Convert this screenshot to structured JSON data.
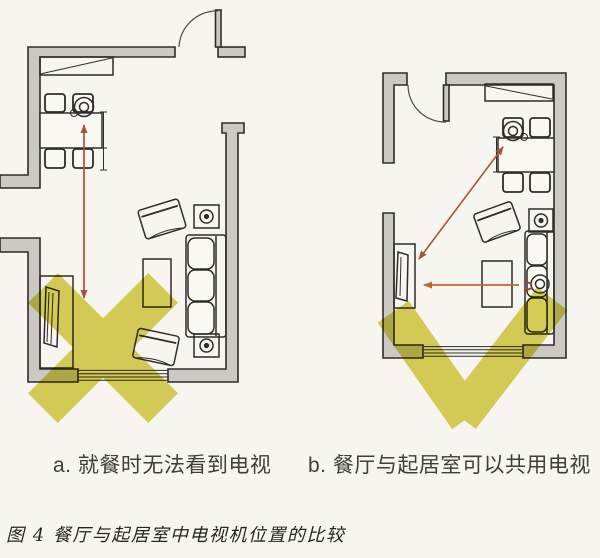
{
  "captions": {
    "a": "a. 就餐时无法看到电视",
    "b": "b. 餐厅与起居室可以共用电视",
    "figure": "图 4 餐厅与起居室中电视机位置的比较"
  },
  "colors": {
    "background": "#f6f5f0",
    "wall_fill": "#cbc9c4",
    "line": "#2e2d2b",
    "door_line": "#4a4a48",
    "mark_yellow": "#d7d04b",
    "arrow_red": "#a5553a",
    "arrow_orange": "#bd6334",
    "caption_text": "#3e3e3c",
    "figure_caption_text": "#26251f"
  },
  "plans": [
    {
      "id": "a",
      "verdict_mark": "x-mark",
      "annotation_arrow": "double-headed sightline from dining seat, blocked",
      "furniture": [
        "sideboard",
        "dining-table",
        "dining-chairs",
        "seated-person",
        "tv-cabinet",
        "armchair",
        "coffee-table",
        "armchair",
        "sofa",
        "side-table-lamp",
        "side-table-lamp",
        "window",
        "door"
      ]
    },
    {
      "id": "b",
      "verdict_mark": "check-mark",
      "annotation_arrow": "sightlines from dining seat and sofa both reach TV",
      "furniture": [
        "sideboard",
        "dining-table",
        "dining-chairs",
        "seated-person",
        "tv-cabinet",
        "armchair",
        "coffee-table",
        "sofa",
        "seated-person",
        "side-table-lamp",
        "window",
        "door"
      ]
    }
  ]
}
